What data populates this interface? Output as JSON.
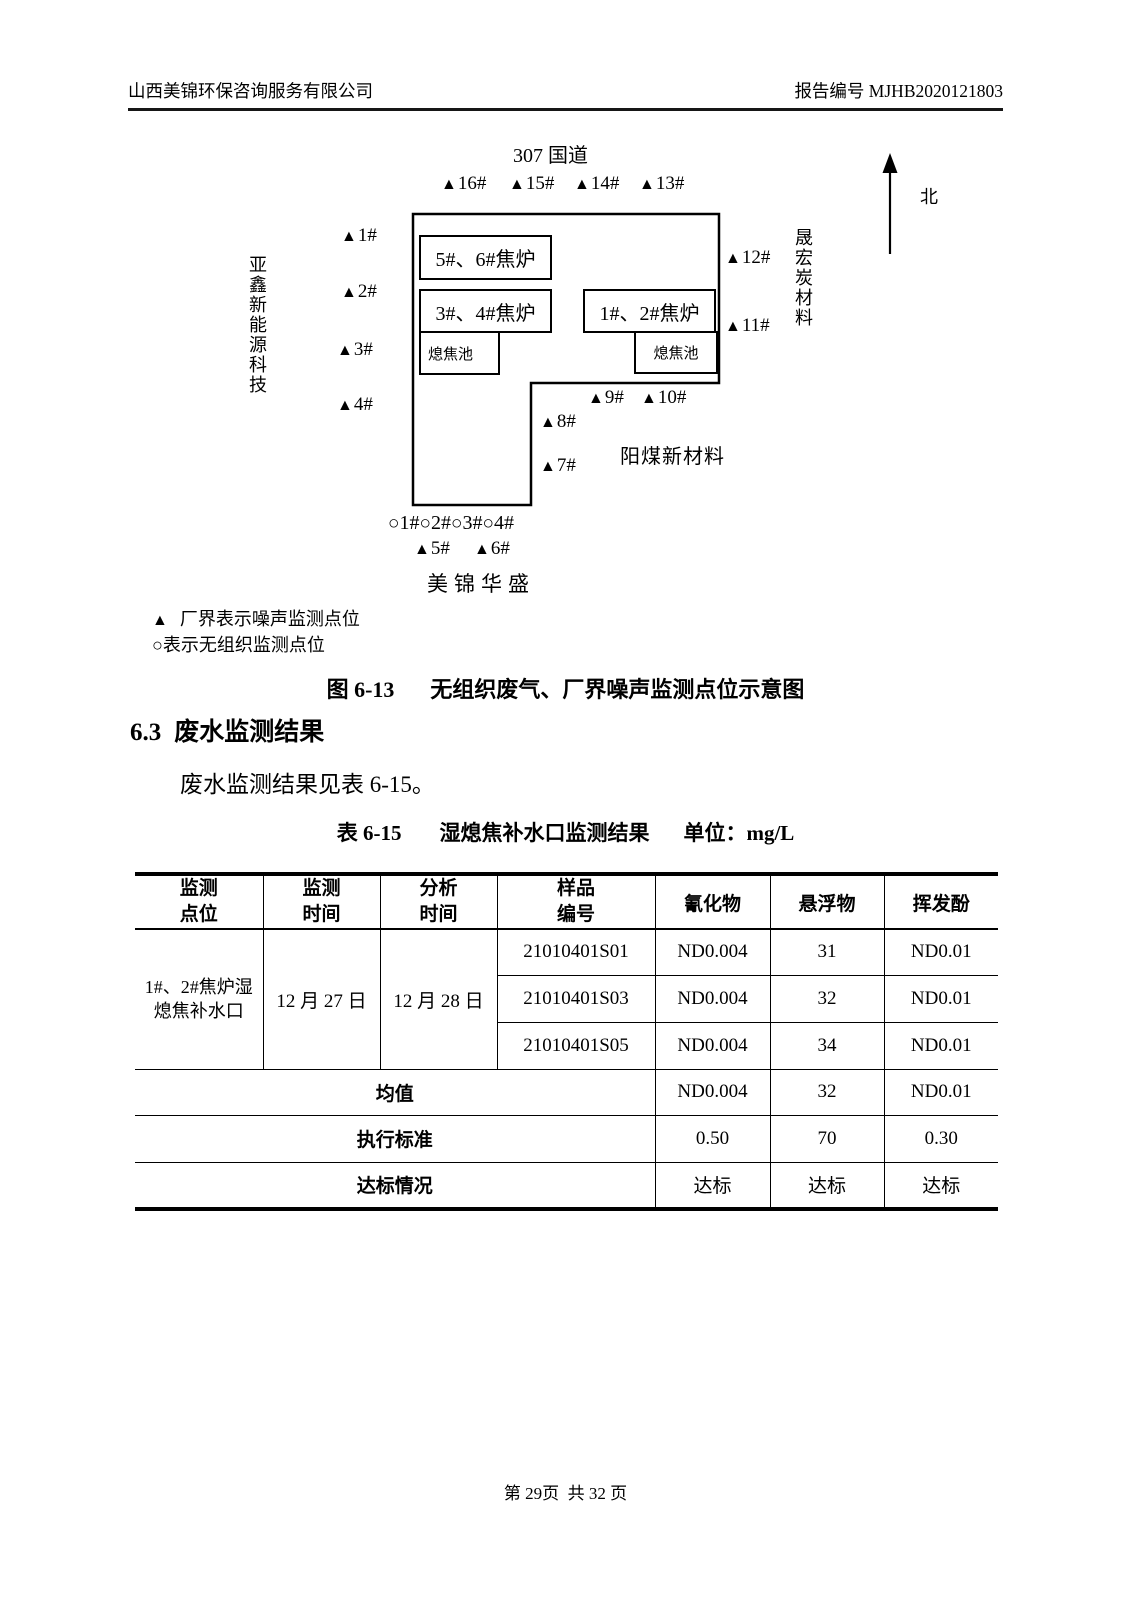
{
  "header": {
    "company": "山西美锦环保咨询服务有限公司",
    "report_no": "报告编号 MJHB2020121803"
  },
  "diagram": {
    "road": "307 国道",
    "north": "北",
    "marker_triangle": "▲",
    "marker_circle": "○",
    "top_points": [
      "16#",
      "15#",
      "14#",
      "13#"
    ],
    "left_points": [
      "1#",
      "2#",
      "3#",
      "4#"
    ],
    "right_points": [
      "12#",
      "11#"
    ],
    "inner_points": [
      "9#",
      "10#",
      "8#",
      "7#"
    ],
    "circle_points": [
      "1#",
      "2#",
      "3#",
      "4#"
    ],
    "bottom_points": [
      "5#",
      "6#"
    ],
    "left_neighbor": "亚鑫新能源科技",
    "right_neighbor": "晟宏炭材料",
    "se_neighbor": "阳煤新材料",
    "south_neighbor": "美锦华盛",
    "building_56": "5#、6#焦炉",
    "building_34": "3#、4#焦炉",
    "building_12": "1#、2#焦炉",
    "pool_label": "熄焦池",
    "legend_triangle_text": "厂界表示噪声监测点位",
    "legend_circle_text": "表示无组织监测点位",
    "caption_label": "图 6-13",
    "caption_text": "无组织废气、厂界噪声监测点位示意图"
  },
  "section": {
    "heading_num": "6.3",
    "heading_text": "废水监测结果",
    "paragraph": "废水监测结果见表 6-15。"
  },
  "table": {
    "label": "表 6-15",
    "title": "湿熄焦补水口监测结果",
    "unit": "单位：mg/L",
    "headers": {
      "site": "监测\n点位",
      "monitor_time": "监测\n时间",
      "analysis_time": "分析\n时间",
      "sample_id": "样品\n编号",
      "cyanide": "氰化物",
      "suspended_solids": "悬浮物",
      "volatile_phenol": "挥发酚"
    },
    "site": "1#、2#焦炉湿\n熄焦补水口",
    "monitor_time": "12 月 27 日",
    "analysis_time": "12 月 28 日",
    "samples": [
      {
        "id": "21010401S01",
        "cyanide": "ND0.004",
        "suspended_solids": "31",
        "volatile_phenol": "ND0.01"
      },
      {
        "id": "21010401S03",
        "cyanide": "ND0.004",
        "suspended_solids": "32",
        "volatile_phenol": "ND0.01"
      },
      {
        "id": "21010401S05",
        "cyanide": "ND0.004",
        "suspended_solids": "34",
        "volatile_phenol": "ND0.01"
      }
    ],
    "mean": {
      "label": "均值",
      "cyanide": "ND0.004",
      "suspended_solids": "32",
      "volatile_phenol": "ND0.01"
    },
    "standard": {
      "label": "执行标准",
      "cyanide": "0.50",
      "suspended_solids": "70",
      "volatile_phenol": "0.30"
    },
    "compliance": {
      "label": "达标情况",
      "cyanide": "达标",
      "suspended_solids": "达标",
      "volatile_phenol": "达标"
    }
  },
  "footer": {
    "page_info": "第 29页  共 32 页"
  }
}
